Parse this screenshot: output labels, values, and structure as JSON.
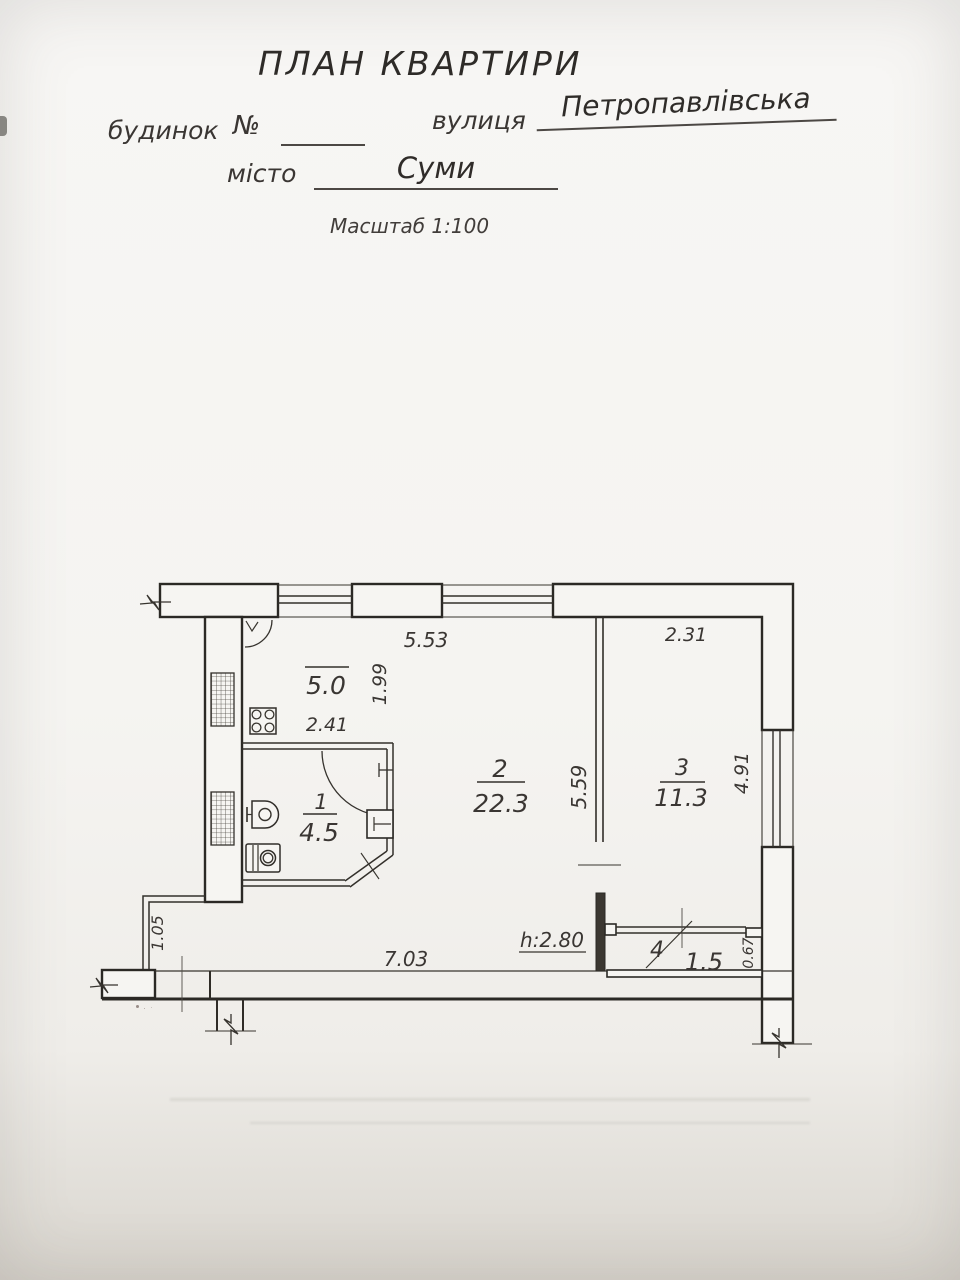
{
  "header": {
    "title": "ПЛАН КВАРТИРИ",
    "house_label": "будинок",
    "number_sign": "№",
    "street_label": "вулиця",
    "street_value": "Петропавлівська",
    "city_label": "місто",
    "city_value": "Суми",
    "scale_label": "Масштаб 1:100"
  },
  "plan": {
    "kitchen": {
      "area": "5.0"
    },
    "rooms": [
      {
        "number": "1",
        "area": "4.5"
      },
      {
        "number": "2",
        "area": "22.3"
      },
      {
        "number": "3",
        "area": "11.3"
      },
      {
        "number": "4",
        "area": "1.5"
      }
    ],
    "dims": {
      "top_window": "5.53",
      "room3_top": "2.31",
      "kitchen_depth": "1.99",
      "kitchen_width": "2.41",
      "room2_wall": "5.59",
      "room3_window": "4.91",
      "bottom_wall": "7.03",
      "entry": "1.05",
      "balcony_depth": "0.67",
      "ceiling_height": "h:2.80"
    }
  }
}
